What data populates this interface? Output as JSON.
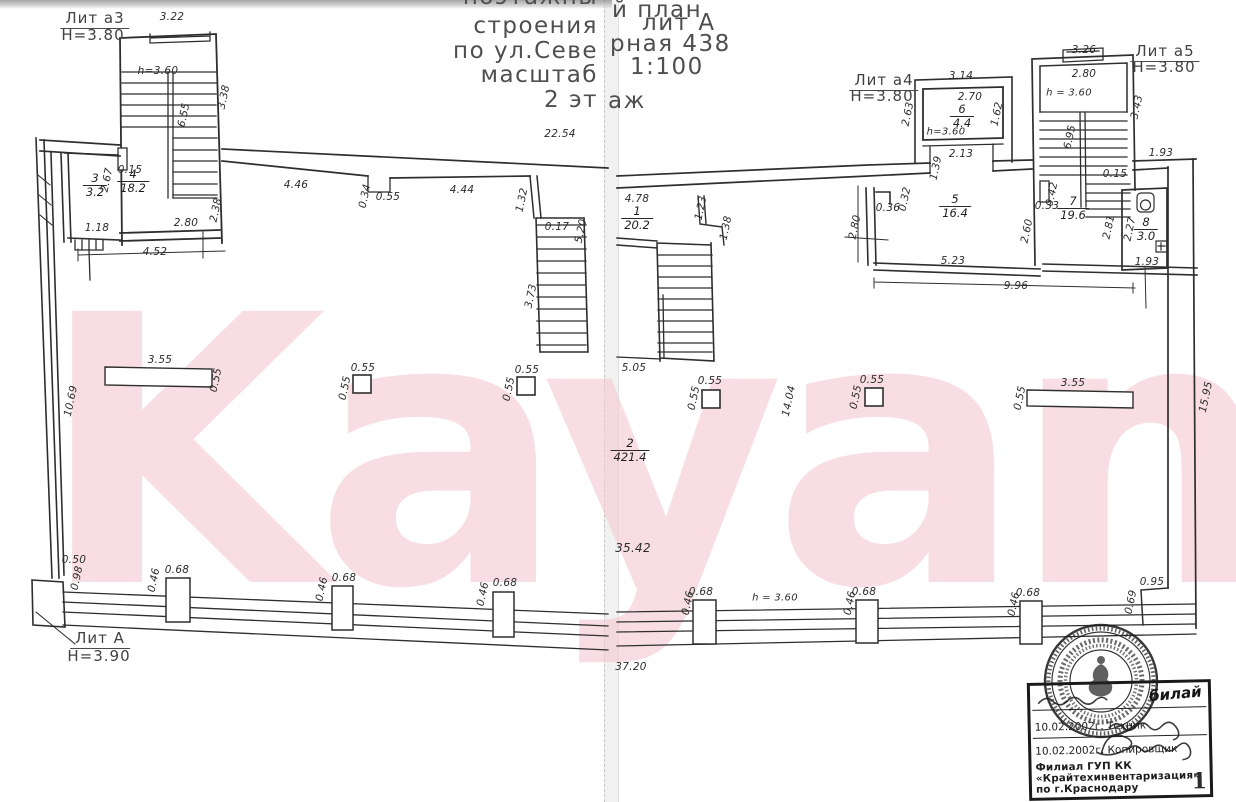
{
  "colors": {
    "ink": "#2e2e2e",
    "watermark_pink": "#f5cbd4",
    "paper": "#ffffff",
    "seal_ink": "#1c1c1c"
  },
  "watermark": "Kayan",
  "title": {
    "l0": "поэтажны",
    "l1": "строения",
    "l2": "по ул.Севе",
    "l3": "масштаб",
    "l4": "2 эт",
    "r0": "й план",
    "r1": "лит А",
    "r2": "рная 438",
    "r3": "1:100",
    "r4": "аж"
  },
  "plan": {
    "labels": [
      {
        "t": "Лит а3",
        "x": 95,
        "y": 19,
        "big": 1,
        "u": 1
      },
      {
        "t": "Н=3.80",
        "x": 93,
        "y": 35,
        "big": 1
      },
      {
        "t": "3.22",
        "x": 172,
        "y": 17
      },
      {
        "t": "3.38",
        "x": 224,
        "y": 97,
        "r": -78
      },
      {
        "t": "h=3.60",
        "x": 158,
        "y": 71
      },
      {
        "t": "6.55",
        "x": 184,
        "y": 115,
        "r": -78
      },
      {
        "t": "0.15",
        "x": 130,
        "y": 170
      },
      {
        "t": "2.67",
        "x": 107,
        "y": 180,
        "r": -78
      },
      {
        "t": "1.18",
        "x": 97,
        "y": 228
      },
      {
        "t": "2.80",
        "x": 186,
        "y": 223
      },
      {
        "t": "2.38",
        "x": 216,
        "y": 210,
        "r": -78
      },
      {
        "t": "4.52",
        "x": 155,
        "y": 252
      },
      {
        "t": "22.54",
        "x": 560,
        "y": 134
      },
      {
        "t": "4.46",
        "x": 296,
        "y": 185
      },
      {
        "t": "0.34",
        "x": 365,
        "y": 196,
        "r": -78
      },
      {
        "t": "0.55",
        "x": 388,
        "y": 197
      },
      {
        "t": "4.44",
        "x": 462,
        "y": 190
      },
      {
        "t": "1.32",
        "x": 522,
        "y": 200,
        "r": -78
      },
      {
        "t": "0.17",
        "x": 557,
        "y": 227
      },
      {
        "t": "5.20",
        "x": 581,
        "y": 231,
        "r": -78
      },
      {
        "t": "3.73",
        "x": 531,
        "y": 296,
        "r": -78
      },
      {
        "t": "10.69",
        "x": 71,
        "y": 401,
        "r": -78
      },
      {
        "t": "3.55",
        "x": 160,
        "y": 360
      },
      {
        "t": "0.55",
        "x": 216,
        "y": 380,
        "r": -78
      },
      {
        "t": "0.55",
        "x": 363,
        "y": 368
      },
      {
        "t": "0.55",
        "x": 345,
        "y": 388,
        "r": -78
      },
      {
        "t": "0.55",
        "x": 527,
        "y": 370
      },
      {
        "t": "0.55",
        "x": 509,
        "y": 389,
        "r": -78
      },
      {
        "t": "0.50",
        "x": 74,
        "y": 560
      },
      {
        "t": "0.98",
        "x": 77,
        "y": 578,
        "r": -78
      },
      {
        "t": "0.46",
        "x": 154,
        "y": 580,
        "r": -78
      },
      {
        "t": "0.68",
        "x": 177,
        "y": 570
      },
      {
        "t": "0.46",
        "x": 322,
        "y": 589,
        "r": -78
      },
      {
        "t": "0.68",
        "x": 344,
        "y": 578
      },
      {
        "t": "0.46",
        "x": 483,
        "y": 594,
        "r": -78
      },
      {
        "t": "0.68",
        "x": 505,
        "y": 583
      },
      {
        "t": "Лит А",
        "x": 100,
        "y": 639,
        "big": 1,
        "u": 1
      },
      {
        "t": "Н=3.90",
        "x": 99,
        "y": 656,
        "big": 1
      },
      {
        "t": "4.78",
        "x": 637,
        "y": 199
      },
      {
        "t": "1.23",
        "x": 701,
        "y": 208,
        "r": -78
      },
      {
        "t": "1.38",
        "x": 726,
        "y": 228,
        "r": -78
      },
      {
        "t": "5.05",
        "x": 634,
        "y": 368
      },
      {
        "t": "2.80",
        "x": 855,
        "y": 227,
        "r": -78
      },
      {
        "t": "0.36",
        "x": 888,
        "y": 208
      },
      {
        "t": "0.32",
        "x": 905,
        "y": 199,
        "r": -78
      },
      {
        "t": "Лит а4",
        "x": 884,
        "y": 81,
        "big": 1,
        "u": 1
      },
      {
        "t": "Н=3.80",
        "x": 882,
        "y": 96,
        "big": 1
      },
      {
        "t": "3.14",
        "x": 961,
        "y": 76
      },
      {
        "t": "2.70",
        "x": 970,
        "y": 97
      },
      {
        "t": "2.63",
        "x": 908,
        "y": 114,
        "r": -78
      },
      {
        "t": "1.62",
        "x": 997,
        "y": 114,
        "r": -78
      },
      {
        "t": "h=3.60",
        "x": 946,
        "y": 132,
        "fs": 10
      },
      {
        "t": "2.13",
        "x": 961,
        "y": 154
      },
      {
        "t": "1.39",
        "x": 936,
        "y": 168,
        "r": -78
      },
      {
        "t": "5.23",
        "x": 953,
        "y": 261
      },
      {
        "t": "9.96",
        "x": 1016,
        "y": 286
      },
      {
        "t": "2.60",
        "x": 1027,
        "y": 231,
        "r": -78
      },
      {
        "t": "3.26",
        "x": 1084,
        "y": 50
      },
      {
        "t": "Лит а5",
        "x": 1165,
        "y": 52,
        "big": 1,
        "u": 1
      },
      {
        "t": "Н=3.80",
        "x": 1164,
        "y": 67,
        "big": 1
      },
      {
        "t": "2.80",
        "x": 1084,
        "y": 74
      },
      {
        "t": "h = 3.60",
        "x": 1069,
        "y": 93,
        "fs": 10
      },
      {
        "t": "3.43",
        "x": 1137,
        "y": 107,
        "r": -78
      },
      {
        "t": "6.95",
        "x": 1070,
        "y": 137,
        "r": -78
      },
      {
        "t": "0.15",
        "x": 1115,
        "y": 174
      },
      {
        "t": "1.93",
        "x": 1161,
        "y": 153
      },
      {
        "t": "0.42",
        "x": 1052,
        "y": 194,
        "r": -78
      },
      {
        "t": "0.33",
        "x": 1047,
        "y": 206
      },
      {
        "t": "2.81",
        "x": 1109,
        "y": 227,
        "r": -78
      },
      {
        "t": "2.27",
        "x": 1130,
        "y": 229,
        "r": -78
      },
      {
        "t": "1.93",
        "x": 1147,
        "y": 262
      },
      {
        "t": "0.55",
        "x": 710,
        "y": 381
      },
      {
        "t": "0.55",
        "x": 694,
        "y": 398,
        "r": -78
      },
      {
        "t": "0.55",
        "x": 872,
        "y": 380
      },
      {
        "t": "0.55",
        "x": 856,
        "y": 397,
        "r": -78
      },
      {
        "t": "14.04",
        "x": 789,
        "y": 401,
        "r": -78
      },
      {
        "t": "3.55",
        "x": 1073,
        "y": 383
      },
      {
        "t": "0.55",
        "x": 1020,
        "y": 398,
        "r": -78
      },
      {
        "t": "35.42",
        "x": 633,
        "y": 548,
        "fs": 12
      },
      {
        "t": "37.20",
        "x": 631,
        "y": 667
      },
      {
        "t": "15.95",
        "x": 1206,
        "y": 397,
        "r": -78
      },
      {
        "t": "0.95",
        "x": 1152,
        "y": 582
      },
      {
        "t": "0.69",
        "x": 1131,
        "y": 602,
        "r": -78
      },
      {
        "t": "0.46",
        "x": 688,
        "y": 603,
        "r": -78
      },
      {
        "t": "0.68",
        "x": 701,
        "y": 592
      },
      {
        "t": "h = 3.60",
        "x": 775,
        "y": 598,
        "fs": 10
      },
      {
        "t": "0.46",
        "x": 850,
        "y": 603,
        "r": -78
      },
      {
        "t": "0.68",
        "x": 864,
        "y": 592
      },
      {
        "t": "0.46",
        "x": 1014,
        "y": 604,
        "r": -78
      },
      {
        "t": "0.68",
        "x": 1028,
        "y": 593
      }
    ],
    "rooms": [
      {
        "num": "3",
        "den": "3.2",
        "x": 95,
        "y": 172
      },
      {
        "num": "4",
        "den": "18.2",
        "x": 133,
        "y": 168
      },
      {
        "num": "1",
        "den": "20.2",
        "x": 637,
        "y": 205
      },
      {
        "num": "2",
        "den": "421.4",
        "x": 630,
        "y": 437
      },
      {
        "num": "5",
        "den": "16.4",
        "x": 955,
        "y": 193
      },
      {
        "num": "6",
        "den": "4.4",
        "x": 962,
        "y": 103
      },
      {
        "num": "7",
        "den": "19.6",
        "x": 1073,
        "y": 195
      },
      {
        "num": "8",
        "den": "3.0",
        "x": 1146,
        "y": 216
      }
    ]
  },
  "stamp": {
    "sig1": "билай",
    "line2_date": "10.02.2002г.",
    "line2_role": "Техник",
    "line3_date": "10.02.2002г.",
    "line3_role": "Копировщик",
    "org1": "Филиал ГУП КК",
    "org2": "«Крайтехинвентаризация»",
    "org3": "по г.Краснодару",
    "page_num": "1"
  }
}
